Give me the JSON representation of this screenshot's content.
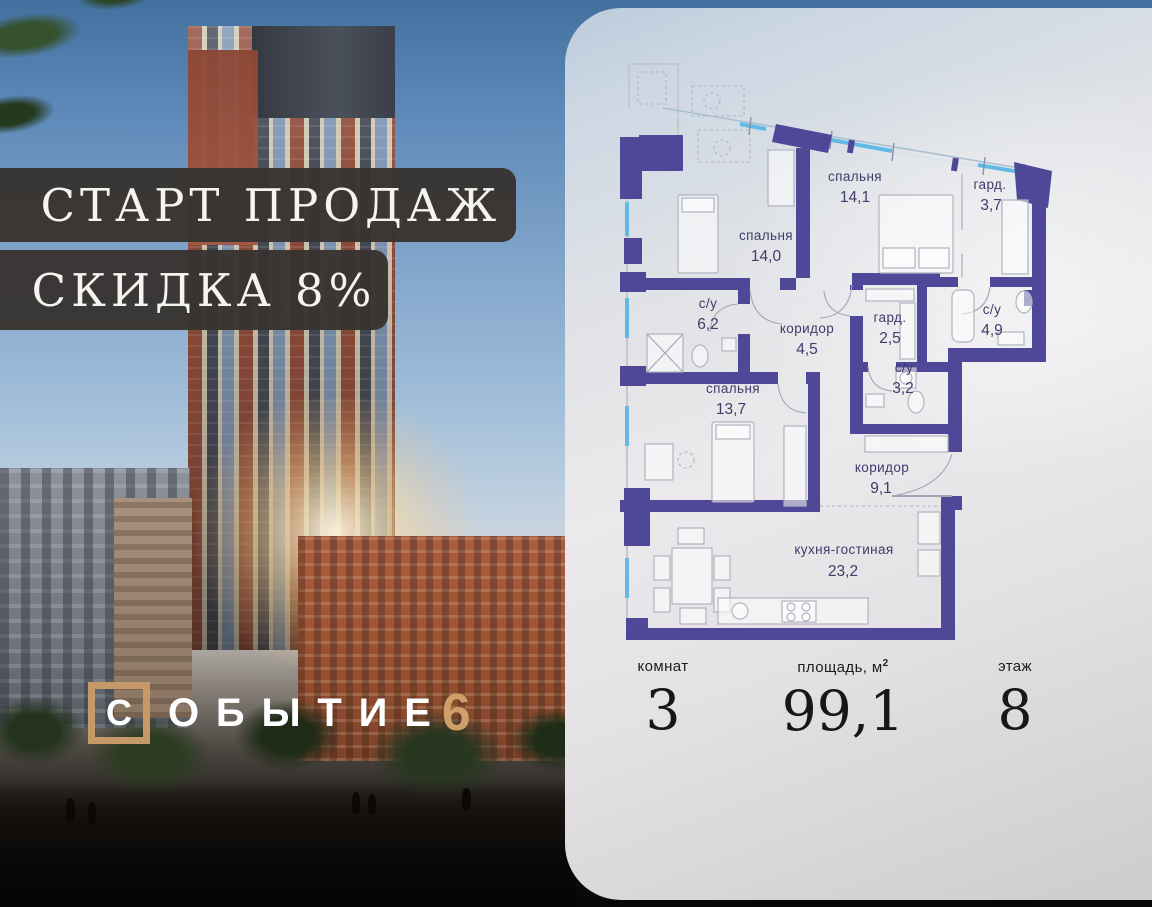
{
  "promo": {
    "badge_start": "СТАРТ ПРОДАЖ",
    "badge_discount": "СКИДКА 8%",
    "logo": {
      "boxed_letter": "С",
      "word_rest": "ОБЫТИЕ",
      "number": "6"
    }
  },
  "plan": {
    "rooms": [
      {
        "name": "спальня",
        "area": "14,1"
      },
      {
        "name": "гард.",
        "area": "3,7"
      },
      {
        "name": "спальня",
        "area": "14,0"
      },
      {
        "name": "с/у",
        "area": "6,2"
      },
      {
        "name": "коридор",
        "area": "4,5"
      },
      {
        "name": "гард.",
        "area": "2,5"
      },
      {
        "name": "с/у",
        "area": "4,9"
      },
      {
        "name": "с/у",
        "area": "3,2"
      },
      {
        "name": "спальня",
        "area": "13,7"
      },
      {
        "name": "коридор",
        "area": "9,1"
      },
      {
        "name": "кухня-гостиная",
        "area": "23,2"
      }
    ]
  },
  "stats": {
    "rooms_label": "комнат",
    "rooms_value": "3",
    "area_label": "площадь, м",
    "area_sup": "2",
    "area_value": "99,1",
    "floor_label": "этаж",
    "floor_value": "8"
  },
  "colors": {
    "wall": "#4f4797",
    "gold": "#c69a68",
    "badge_bg": "#383431",
    "room_label": "#403b6b",
    "window_glass": "#62b9e4"
  }
}
